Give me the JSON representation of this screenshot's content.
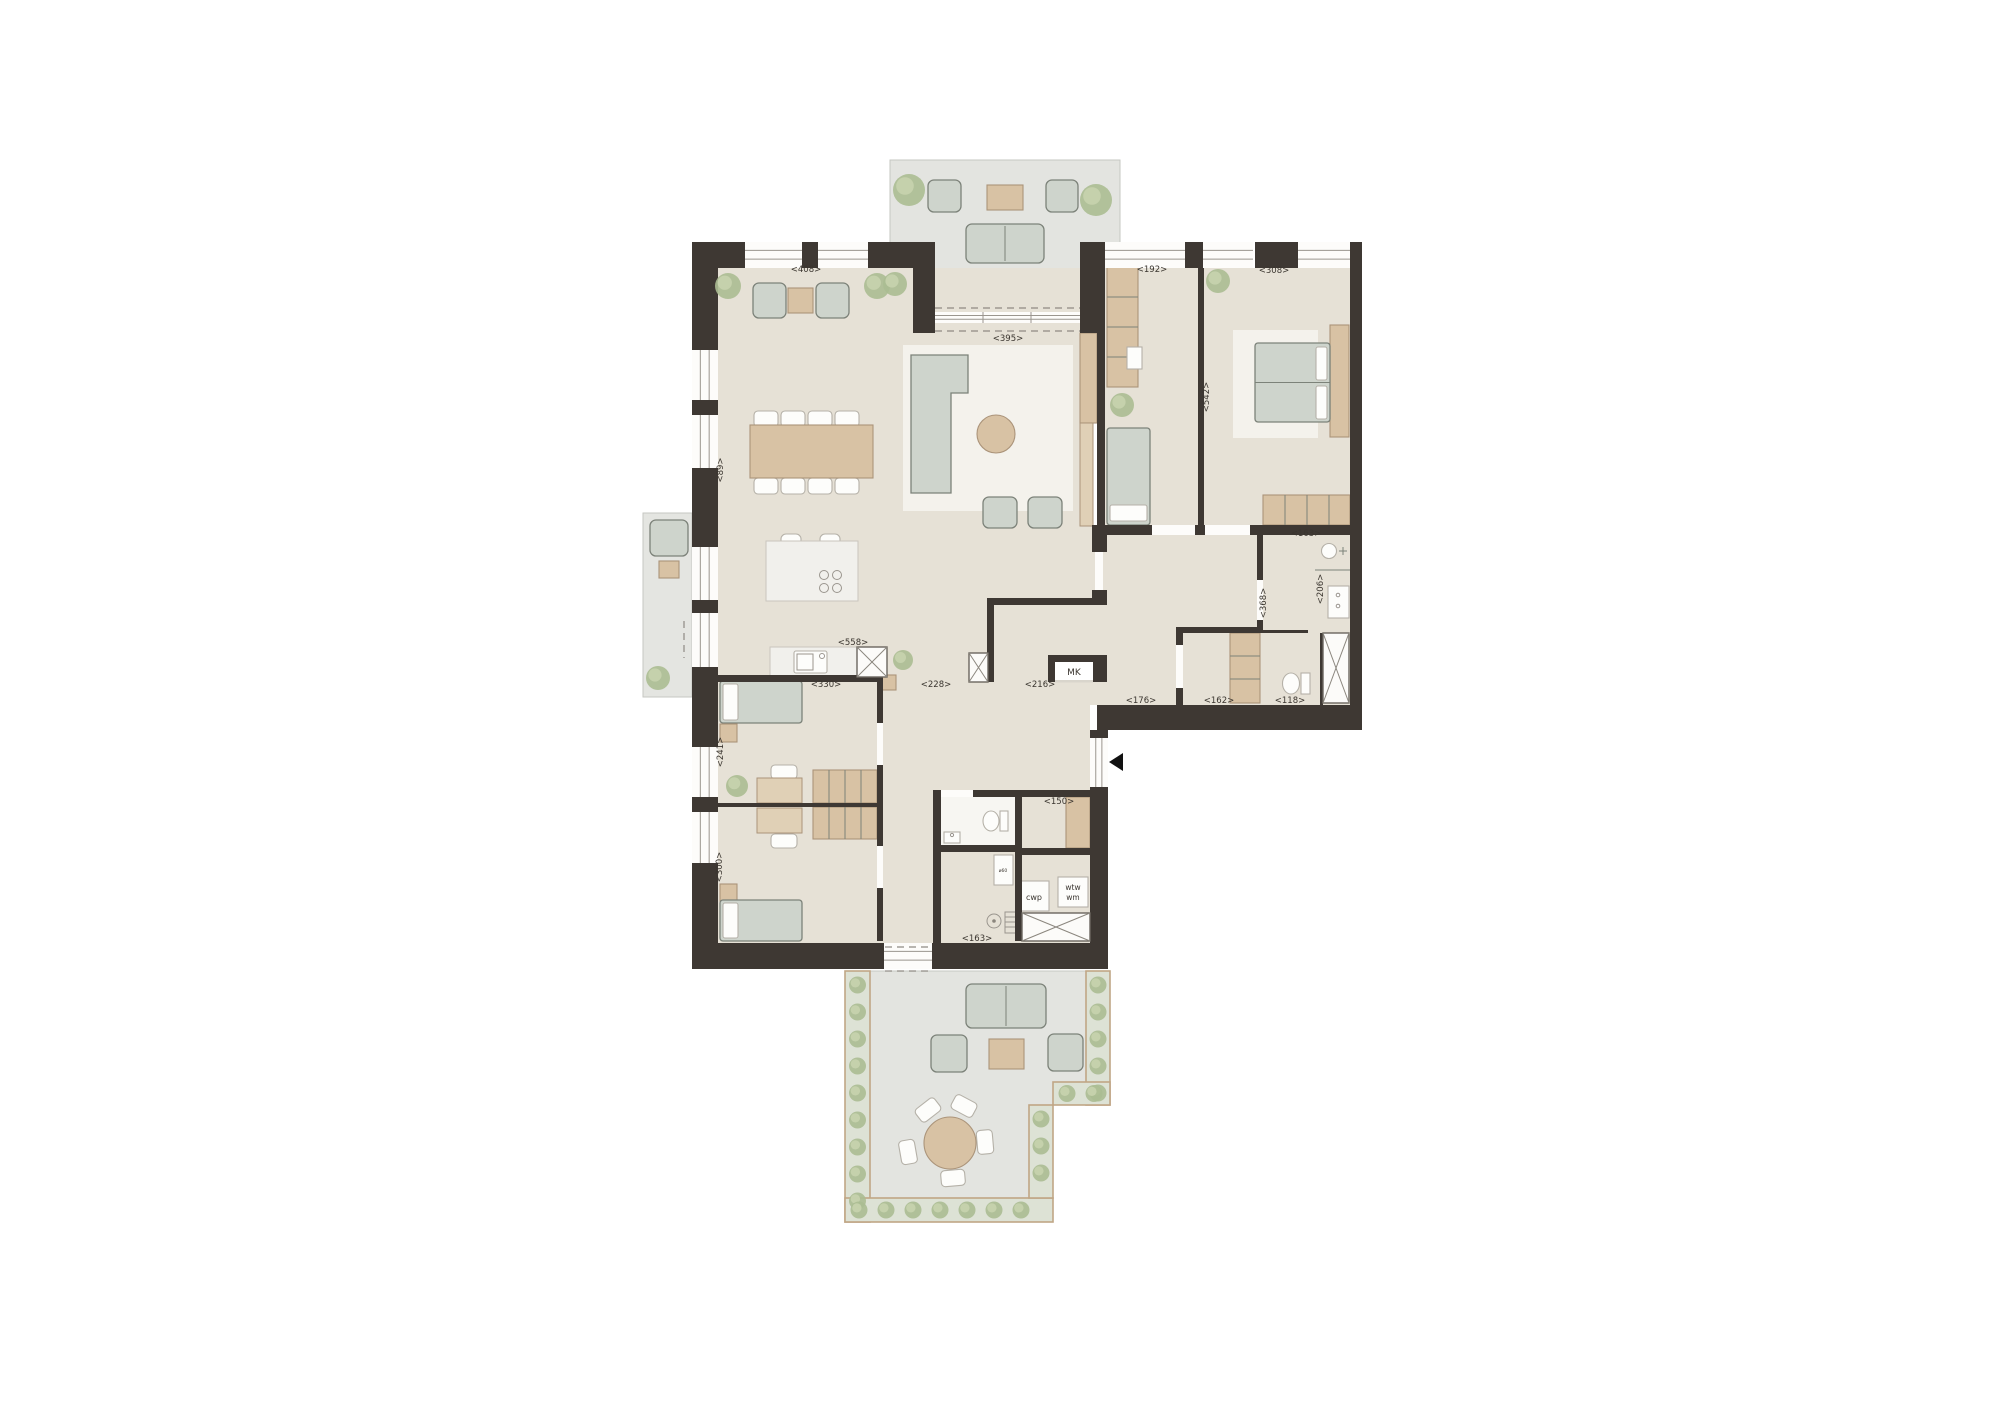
{
  "plan": {
    "dimension_labels": [
      {
        "text": "<408>",
        "x": 806,
        "y": 272,
        "rotate": 0
      },
      {
        "text": "<395>",
        "x": 1008,
        "y": 341,
        "rotate": 0
      },
      {
        "text": "<192>",
        "x": 1152,
        "y": 272,
        "rotate": 0
      },
      {
        "text": "<308>",
        "x": 1274,
        "y": 273,
        "rotate": 0
      },
      {
        "text": "<542>",
        "x": 1209,
        "y": 397,
        "rotate": -90
      },
      {
        "text": "<163>",
        "x": 1306,
        "y": 536,
        "rotate": 0
      },
      {
        "text": "<89>",
        "x": 723,
        "y": 470,
        "rotate": -90
      },
      {
        "text": "<558>",
        "x": 853,
        "y": 645,
        "rotate": 0
      },
      {
        "text": "<330>",
        "x": 826,
        "y": 687,
        "rotate": 0
      },
      {
        "text": "<228>",
        "x": 936,
        "y": 687,
        "rotate": 0
      },
      {
        "text": "<216>",
        "x": 1040,
        "y": 687,
        "rotate": 0
      },
      {
        "text": "<176>",
        "x": 1141,
        "y": 703,
        "rotate": 0
      },
      {
        "text": "<162>",
        "x": 1219,
        "y": 703,
        "rotate": 0
      },
      {
        "text": "<118>",
        "x": 1290,
        "y": 703,
        "rotate": 0
      },
      {
        "text": "<206>",
        "x": 1323,
        "y": 589,
        "rotate": -90
      },
      {
        "text": "<368>",
        "x": 1266,
        "y": 603,
        "rotate": -90
      },
      {
        "text": "<241>",
        "x": 723,
        "y": 752,
        "rotate": -90
      },
      {
        "text": "<300>",
        "x": 722,
        "y": 867,
        "rotate": -90
      },
      {
        "text": "<150>",
        "x": 1059,
        "y": 804,
        "rotate": 0
      },
      {
        "text": "<163>",
        "x": 977,
        "y": 941,
        "rotate": 0
      }
    ],
    "room_labels": [
      {
        "text": "MK",
        "x": 1074,
        "y": 675,
        "size": 9
      },
      {
        "text": "cwp",
        "x": 1034,
        "y": 900,
        "size": 8
      },
      {
        "text": "wtw",
        "x": 1073,
        "y": 890,
        "size": 7.5
      },
      {
        "text": "wm",
        "x": 1073,
        "y": 900,
        "size": 7.5
      },
      {
        "text": "ø60",
        "x": 1003,
        "y": 872,
        "size": 4.5
      }
    ]
  },
  "colors": {
    "wall": "#3e3833",
    "floor": "#e6e1d6",
    "terrace": "#e3e4e0",
    "balcony": "#e4e5e1",
    "rug": "#f4f2ec",
    "bath": "#f7f6f2",
    "marble": "#f1f0ec",
    "wood": "#d8c2a4",
    "wood-lt": "#e0d0b6",
    "wood-bd": "#ab947a",
    "sofa": "#ced4cc",
    "sofa-bd": "#7c8279",
    "white": "#fdfdfb",
    "white-bd": "#b5b1a8",
    "planter": "#dde2d5",
    "planter-bd": "#c0a685",
    "plant": "#abbd92",
    "plant2": "#c8d3ae",
    "dash": "#8f8a84",
    "line": "#9a958e",
    "label": "#3a352f"
  }
}
